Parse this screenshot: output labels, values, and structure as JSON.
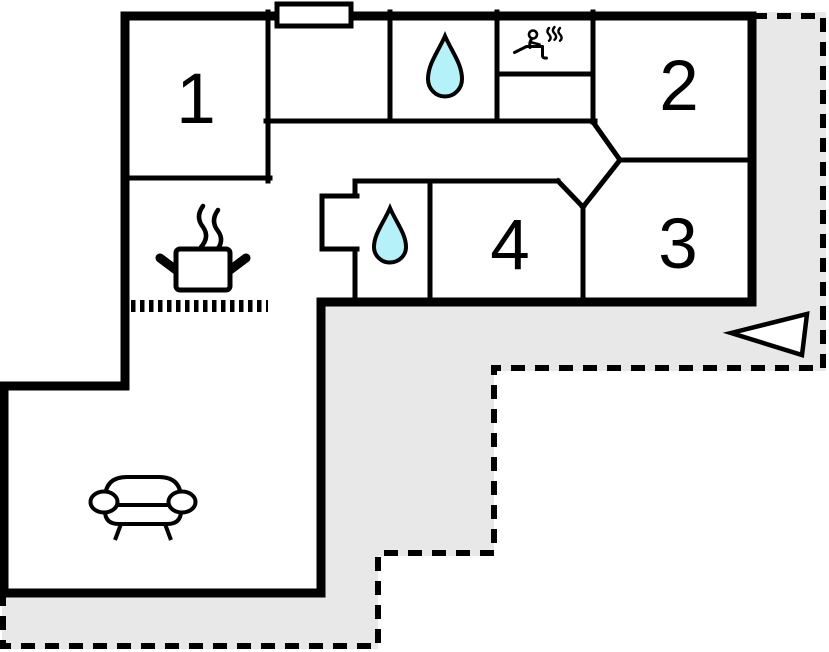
{
  "floor_plan": {
    "rooms": [
      {
        "label": "1"
      },
      {
        "label": "2"
      },
      {
        "label": "3"
      },
      {
        "label": "4"
      }
    ],
    "icons": [
      {
        "name": "water-drop-icon"
      },
      {
        "name": "water-drop-icon"
      },
      {
        "name": "sauna-icon"
      },
      {
        "name": "stove-pot-icon"
      },
      {
        "name": "kitchen-counter-dotted-line"
      },
      {
        "name": "sofa-icon"
      },
      {
        "name": "entrance-arrow-icon"
      },
      {
        "name": "window-marker"
      }
    ],
    "colors": {
      "wall": "#000000",
      "terrace": "#e8e8e8",
      "water": "#b5f1f8",
      "steam": "#8c8c8c",
      "background": "#ffffff"
    }
  }
}
